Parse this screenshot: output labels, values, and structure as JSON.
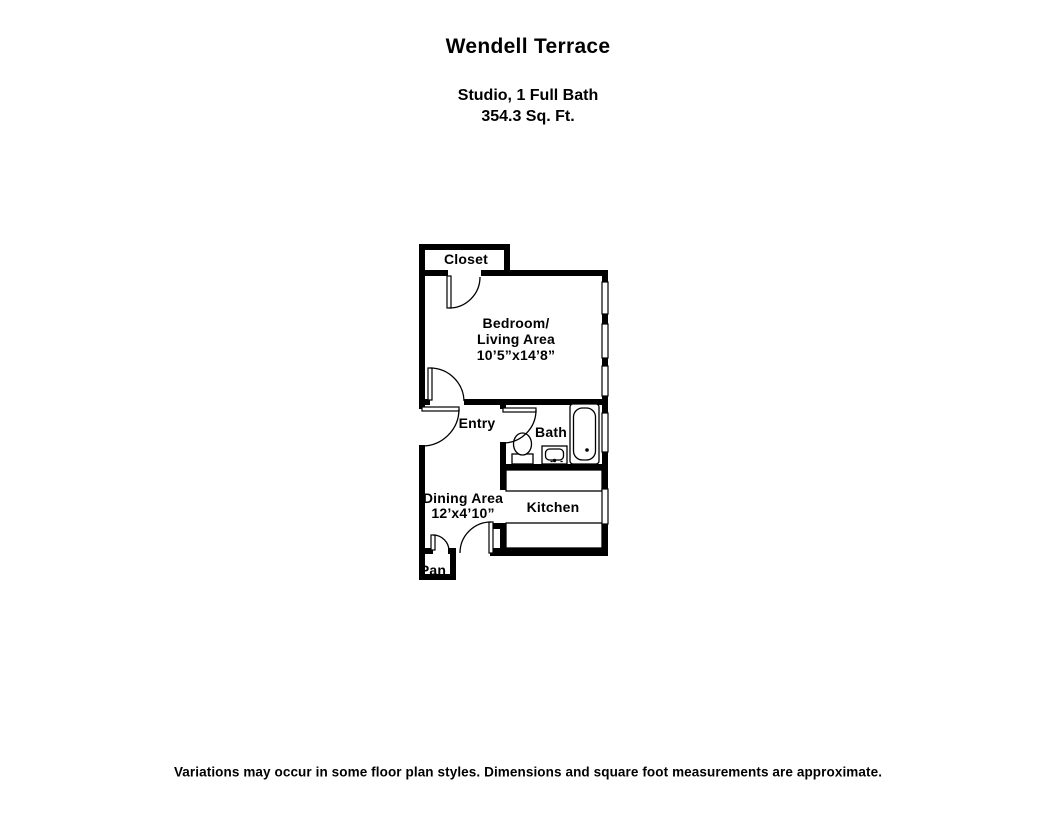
{
  "header": {
    "title": "Wendell Terrace",
    "unit_type": "Studio, 1 Full Bath",
    "square_feet": "354.3 Sq. Ft."
  },
  "rooms": {
    "closet": "Closet",
    "bedroom_line1": "Bedroom/",
    "bedroom_line2": "Living Area",
    "bedroom_line3": "10’5”x14’8”",
    "entry": "Entry",
    "bath": "Bath",
    "dining_line1": "Dining Area",
    "dining_line2": "12’x4’10”",
    "kitchen": "Kitchen",
    "pantry": "Pan"
  },
  "footer": {
    "disclaimer": "Variations may occur in some floor plan styles. Dimensions and square foot measurements are approximate."
  },
  "colors": {
    "walls": "#000000",
    "background": "#ffffff",
    "text": "#000000"
  }
}
